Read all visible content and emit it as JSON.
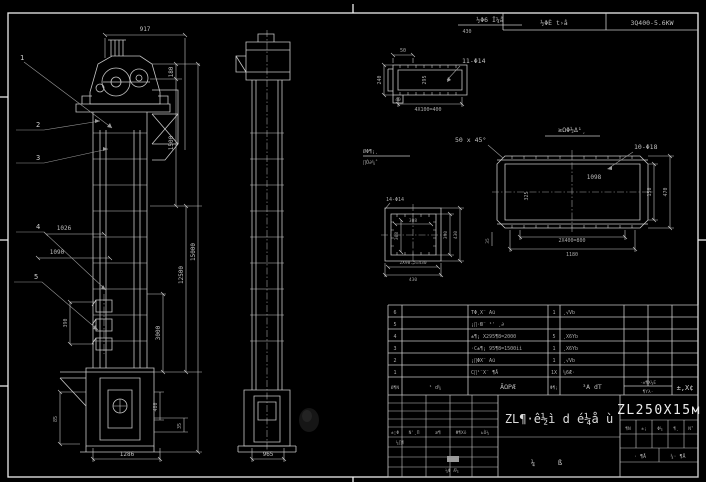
{
  "colors": {
    "background": "#000000",
    "line": "#c6c6c6",
    "frame": "#ededed"
  },
  "header_bar": {
    "field1": "½ΦÈ t›å",
    "field2": "3Q400-5.6KW"
  },
  "detail_label": {
    "line1": "½Φ6 Î¼å",
    "line2": "430"
  },
  "side_notes": {
    "note1": "ØΦ¶¡¸",
    "note2": "∏Ò∂¼˚"
  },
  "front_view": {
    "dim_top": "917",
    "balloon1": "1",
    "balloon2": "2",
    "balloon3": "3",
    "balloon4": "4",
    "balloon5": "5",
    "dim_180": "180",
    "dim_1500": "1500",
    "dim_12500": "12500",
    "dim_3000": "3000",
    "dim_15000": "15000",
    "dim_480": "480",
    "dim_35": "35",
    "dim_1026": "1026",
    "dim_1090": "1090",
    "dim_390": "390",
    "dim_85": "85",
    "dim_1286": "1286"
  },
  "side_view": {
    "dim_965": "965"
  },
  "flange_detail": {
    "callout": "11-Φ14",
    "dim_50": "50",
    "dim_240": "240",
    "dim_295": "295",
    "dim_40": "40",
    "dim_bottom": "4X100=400"
  },
  "casing_detail": {
    "title": "≥ΩΦ½Δ¹¸",
    "chamfer": "50 x 45°",
    "callout": "10-Φ18",
    "dim_1098": "1098",
    "dim_325": "325",
    "dim_150": "150",
    "dim_470": "470",
    "dim_800": "2X400=800",
    "dim_1180": "1180",
    "dim_35": "35"
  },
  "square_detail": {
    "callout": "14-Φ14",
    "dim_w": "308",
    "dim_h": "308",
    "dim_b1": "2X98.5=430",
    "dim_b2": "430",
    "dim_390": "390",
    "dim_430": "430"
  },
  "bom": {
    "rows": [
      {
        "no": "6",
        "code": "",
        "name": "TΦ¸X¨ Aü",
        "qty": "1",
        "mat": "¸√Vb"
      },
      {
        "no": "5",
        "code": "",
        "name": "¡∏·Ю¨ ¹' ¸∂",
        "qty": "",
        "mat": ""
      },
      {
        "no": "4",
        "code": "",
        "name": "±¶¡ X295¶8=2000",
        "qty": "5",
        "mat": "¸X6Yb"
      },
      {
        "no": "3",
        "code": "",
        "name": "·C±¶¡ 95¶8=1500ìì",
        "qty": "1",
        "mat": "¸X6Yb"
      },
      {
        "no": "2",
        "code": "",
        "name": "¡∏ΦX¨ Aü",
        "qty": "1",
        "mat": "¸√Vb"
      },
      {
        "no": "1",
        "code": "",
        "name": "C∏¹¨X¨ ¶Å",
        "qty": "1X",
        "mat": "¼6Æ·"
      }
    ],
    "header": {
      "no": "Ø¶Ν",
      "code": "¹ d¼",
      "name": "ÃΩΡÆ",
      "qty": "Φ¶¡",
      "mat": "³Α dΤ",
      "weight_top": "·±¶X¼E",
      "weight_bottom": "¶Yλ·",
      "remark": "±,X¢"
    }
  },
  "title_block": {
    "model": "ZL250X15м",
    "title_main": "ZL¶·ê½ì d é¼å ù",
    "glyph1": "¼",
    "glyph2": "ß",
    "rev": [
      "±¦Φ",
      "Ν'¸Π",
      "æ¶",
      "Φ¶Xõ",
      "ьÒ¼"
    ],
    "rev_left": "¼∏¶",
    "rev_footer": "¼Φ Æ¼",
    "row1": [
      "¶Ν",
      "±¡",
      "Φ¼",
      "¶¸",
      "Ν˚"
    ],
    "sheet_left": "· ¶Å",
    "sheet_right": "¼· ¶Å"
  }
}
